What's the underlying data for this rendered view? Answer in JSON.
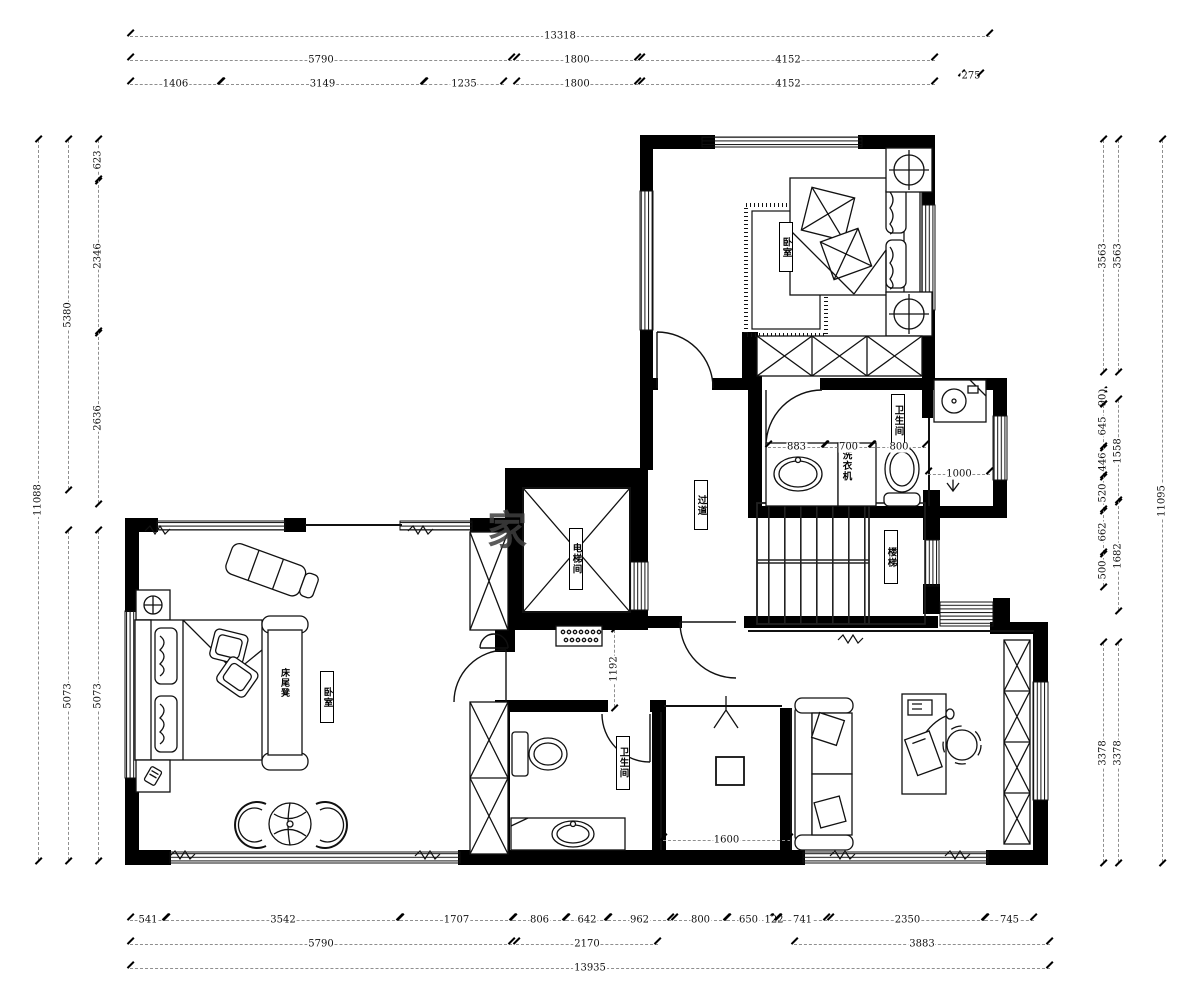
{
  "title": "二层平面布置图",
  "colors": {
    "wall": "#000000",
    "line": "#111111",
    "dim_line": "#8f8f8f",
    "dim_text": "#111111",
    "bg": "#ffffff",
    "watermark": "#3f3f3f"
  },
  "watermark": {
    "text": "家"
  },
  "labels": {
    "bedroom_top": "卧室",
    "bath_top": "卫生间",
    "washer": "洗衣机",
    "corridor": "过道",
    "elevator": "电梯间",
    "stairs": "楼梯",
    "bench": "床尾凳",
    "bedroom_left": "卧室",
    "bath_lower": "卫生间"
  },
  "icons": {
    "slope_arrow": "down-arrow-icon",
    "entry_arrow": "up-arrow-icon"
  },
  "dims": {
    "h": [
      {
        "label": "13318",
        "x": 130,
        "y": 36,
        "len": 860
      },
      {
        "label": "5790",
        "x": 130,
        "y": 60,
        "len": 382
      },
      {
        "label": "1800",
        "x": 516,
        "y": 60,
        "len": 122
      },
      {
        "label": "4152",
        "x": 641,
        "y": 60,
        "len": 294
      },
      {
        "label": "275",
        "x": 961,
        "y": 76,
        "len": 20
      },
      {
        "label": "1406",
        "x": 130,
        "y": 84,
        "len": 91
      },
      {
        "label": "3149",
        "x": 221,
        "y": 84,
        "len": 203
      },
      {
        "label": "1235",
        "x": 424,
        "y": 84,
        "len": 80
      },
      {
        "label": "1800",
        "x": 516,
        "y": 84,
        "len": 122
      },
      {
        "label": "4152",
        "x": 641,
        "y": 84,
        "len": 294
      },
      {
        "label": "541",
        "x": 130,
        "y": 920,
        "len": 36
      },
      {
        "label": "3542",
        "x": 166,
        "y": 920,
        "len": 234
      },
      {
        "label": "1707",
        "x": 400,
        "y": 920,
        "len": 113
      },
      {
        "label": "806",
        "x": 513,
        "y": 920,
        "len": 53
      },
      {
        "label": "642",
        "x": 566,
        "y": 920,
        "len": 42
      },
      {
        "label": "962",
        "x": 608,
        "y": 920,
        "len": 63
      },
      {
        "label": "800",
        "x": 674,
        "y": 920,
        "len": 53
      },
      {
        "label": "650",
        "x": 727,
        "y": 920,
        "len": 43
      },
      {
        "label": "122",
        "x": 770,
        "y": 920,
        "len": 8
      },
      {
        "label": "741",
        "x": 778,
        "y": 920,
        "len": 49
      },
      {
        "label": "2350",
        "x": 830,
        "y": 920,
        "len": 155
      },
      {
        "label": "745",
        "x": 985,
        "y": 920,
        "len": 49
      },
      {
        "label": "5790",
        "x": 130,
        "y": 944,
        "len": 382
      },
      {
        "label": "2170",
        "x": 516,
        "y": 944,
        "len": 142
      },
      {
        "label": "3883",
        "x": 794,
        "y": 944,
        "len": 256
      },
      {
        "label": "13935",
        "x": 130,
        "y": 968,
        "len": 920
      },
      {
        "label": "883",
        "x": 768,
        "y": 447,
        "len": 57
      },
      {
        "label": "700",
        "x": 825,
        "y": 447,
        "len": 47
      },
      {
        "label": "800",
        "x": 872,
        "y": 447,
        "len": 54
      },
      {
        "label": "1000",
        "x": 928,
        "y": 474,
        "len": 62
      },
      {
        "label": "1600",
        "x": 663,
        "y": 840,
        "len": 127
      }
    ],
    "v": [
      {
        "label": "11088",
        "x": 38,
        "y": 140,
        "len": 720
      },
      {
        "label": "5380",
        "x": 68,
        "y": 140,
        "len": 349
      },
      {
        "label": "5073",
        "x": 68,
        "y": 531,
        "len": 329
      },
      {
        "label": "623",
        "x": 98,
        "y": 140,
        "len": 40
      },
      {
        "label": "2346",
        "x": 98,
        "y": 180,
        "len": 152
      },
      {
        "label": "2636",
        "x": 98,
        "y": 332,
        "len": 171
      },
      {
        "label": "5073",
        "x": 98,
        "y": 531,
        "len": 329
      },
      {
        "label": "11095",
        "x": 1162,
        "y": 140,
        "len": 722
      },
      {
        "label": "3563",
        "x": 1118,
        "y": 140,
        "len": 231
      },
      {
        "label": "1558",
        "x": 1118,
        "y": 400,
        "len": 101
      },
      {
        "label": "1682",
        "x": 1118,
        "y": 501,
        "len": 109
      },
      {
        "label": "3378",
        "x": 1118,
        "y": 643,
        "len": 219
      },
      {
        "label": "3563",
        "x": 1103,
        "y": 140,
        "len": 231
      },
      {
        "label": "0",
        "x": 1103,
        "y": 391,
        "len": 2
      },
      {
        "label": "90",
        "x": 1103,
        "y": 396,
        "len": 7
      },
      {
        "label": "645",
        "x": 1103,
        "y": 405,
        "len": 42
      },
      {
        "label": "446",
        "x": 1103,
        "y": 447,
        "len": 29
      },
      {
        "label": "520",
        "x": 1103,
        "y": 476,
        "len": 34
      },
      {
        "label": "662",
        "x": 1103,
        "y": 510,
        "len": 43
      },
      {
        "label": "500",
        "x": 1103,
        "y": 553,
        "len": 33
      },
      {
        "label": "3378",
        "x": 1103,
        "y": 643,
        "len": 219
      },
      {
        "label": "1192",
        "x": 614,
        "y": 630,
        "len": 77
      }
    ]
  }
}
